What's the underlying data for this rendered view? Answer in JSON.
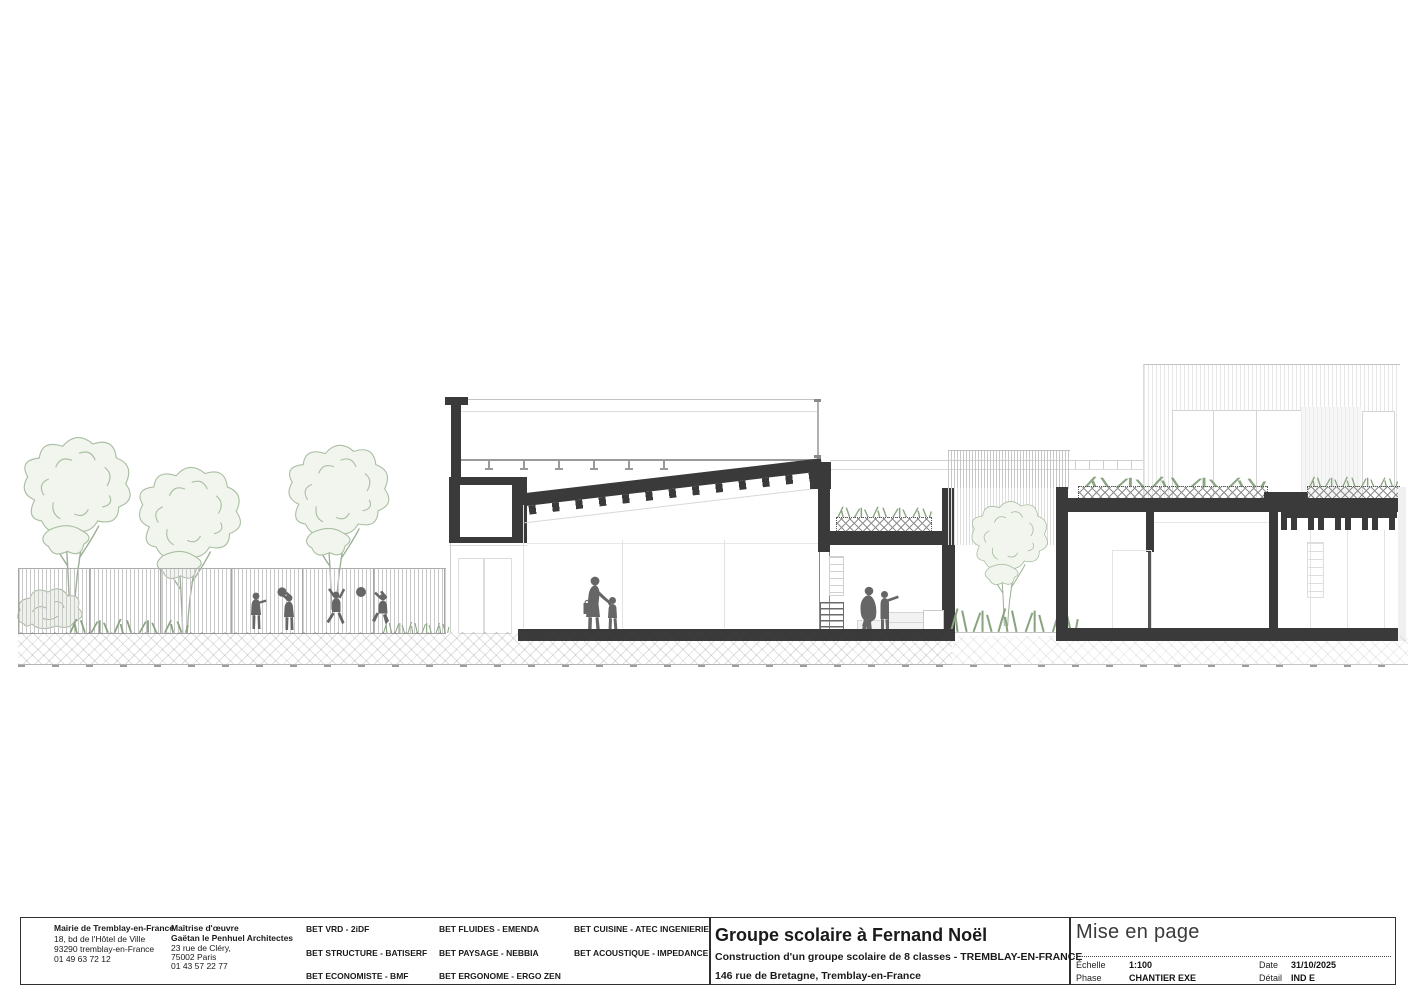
{
  "title_block": {
    "client": {
      "name": "Mairie de Tremblay-en-France",
      "address1": "18, bd de l'Hôtel de Ville",
      "address2": "93290 tremblay-en-France",
      "phone": "01 49 63 72 12"
    },
    "moe": {
      "role": "Maîtrise d'œuvre",
      "name": "Gaëtan le Penhuel Architectes",
      "address1": "23 rue de Cléry,",
      "address2": "75002 Paris",
      "phone": "01 43 57 22 77"
    },
    "bets": {
      "col1": [
        "BET VRD - 2iDF",
        "BET STRUCTURE  - BATISERF",
        "BET ECONOMISTE  - BMF"
      ],
      "col2": [
        "BET FLUIDES - EMENDA",
        "BET PAYSAGE  - NEBBIA",
        "BET ERGONOME  - ERGO ZEN"
      ],
      "col3": [
        "BET CUISINE - ATEC INGENIERIE",
        "BET ACOUSTIQUE  - IMPEDANCE"
      ]
    },
    "project": {
      "title": "Groupe scolaire à Fernand Noël",
      "subtitle": "Construction d'un groupe scolaire de 8 classes - TREMBLAY-EN-FRANCE",
      "address": "146 rue de Bretagne, Tremblay-en-France"
    },
    "sheet_info": {
      "name": "Mise en page",
      "scale_label": "Échelle",
      "scale": "1:100",
      "phase_label": "Phase",
      "phase": "CHANTIER EXE",
      "date_label": "Date",
      "date": "31/10/2025",
      "detail_label": "Détail",
      "detail": "IND  E"
    }
  },
  "colors": {
    "cut_ink": "#3a3a3a",
    "silhouette": "#666666",
    "vegetation_stroke": "#aabfa2",
    "hatch": "#8d8d8d"
  }
}
